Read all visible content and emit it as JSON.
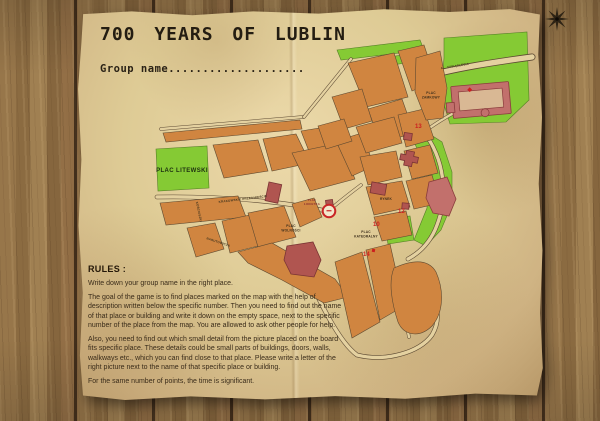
{
  "poster": {
    "title": "700 YEARS OF LUBLIN",
    "group_name": "Group name....................",
    "rules": {
      "heading": "RULES :",
      "paragraphs": [
        "Write down your group name in the right place.",
        "The goal of the game is to find places marked on the map with the help of description written below the specific number. Then you need to find out the name of that place or building and write it down on the empty space, next to the specific number of the place from the map. You are allowed to ask other people for help.",
        "Also, you need to find out which small detail from the picture placed on the board fits specific place. These details could be small parts of buildings, doors, walls, walkways etc., which you can find close to that place. Please write a letter of the right picture next to the name of that specific place or building.",
        "For the same number of points, the time is significant."
      ]
    }
  },
  "map": {
    "parks": {
      "plac_litewski": "PLAC LITEWSKI"
    },
    "squares": {
      "plac_lokietka": [
        "PLAC",
        "ŁOKIETKA"
      ],
      "plac_wolnosci": [
        "PLAC",
        "WOLNOŚCI"
      ],
      "plac_katedralny": [
        "PLAC",
        "KATEDRALNY"
      ],
      "plac_zamkowy": [
        "PLAC",
        "ZAMKOWY"
      ],
      "rynek": "RYNEK"
    },
    "streets": {
      "krakowskie_przedmiescie": "KRAKOWSKIE PRZEDMIEŚCIE",
      "narutowicza": "NARUTOWICZA",
      "kosciuszki": "KOŚCIUSZKI",
      "al_tysiaclecia": "AL. TYSIĄCLECIA"
    },
    "markers": [
      {
        "label": "10"
      },
      {
        "label": "12"
      },
      {
        "label": "13"
      },
      {
        "label": "14"
      }
    ]
  },
  "colors": {
    "building_block": "#d08540",
    "park": "#85ca34",
    "landmark": "#b05550",
    "marker_red": "#cc1f1f",
    "paper": "#decb95",
    "wood": "#8b6b41"
  }
}
